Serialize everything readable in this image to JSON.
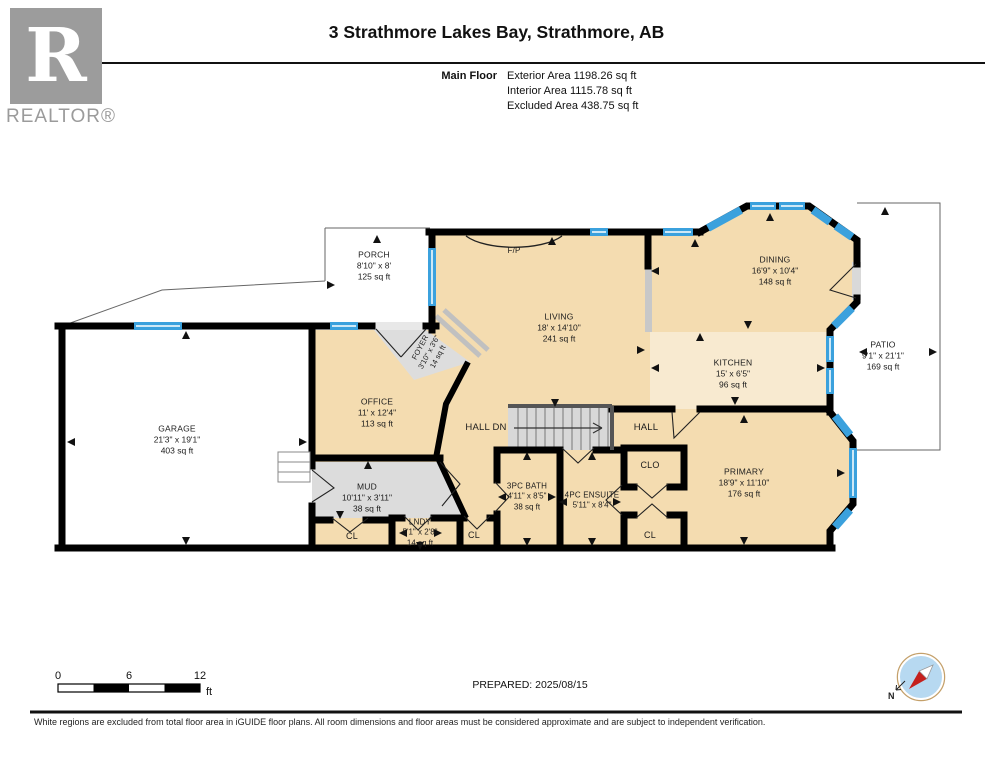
{
  "header": {
    "title": "3 Strathmore Lakes Bay, Strathmore, AB",
    "floor_label": "Main Floor",
    "stats": {
      "exterior": "Exterior Area 1198.26 sq ft",
      "interior": "Interior Area 1115.78 sq ft",
      "excluded": "Excluded Area 438.75 sq ft"
    }
  },
  "logo": {
    "letter": "R",
    "word": "REALTOR®"
  },
  "rooms": {
    "garage": {
      "name": "GARAGE",
      "dims": "21'3\" x 19'1\"",
      "area": "403 sq ft"
    },
    "porch": {
      "name": "PORCH",
      "dims": "8'10\" x 8'",
      "area": "125 sq ft"
    },
    "living": {
      "name": "LIVING",
      "dims": "18' x 14'10\"",
      "area": "241 sq ft"
    },
    "dining": {
      "name": "DINING",
      "dims": "16'9\" x 10'4\"",
      "area": "148 sq ft"
    },
    "patio": {
      "name": "PATIO",
      "dims": "9'1\" x 21'1\"",
      "area": "169 sq ft"
    },
    "kitchen": {
      "name": "KITCHEN",
      "dims": "15' x 6'5\"",
      "area": "96 sq ft"
    },
    "office": {
      "name": "OFFICE",
      "dims": "11' x 12'4\"",
      "area": "113 sq ft"
    },
    "foyer": {
      "name": "FOYER",
      "dims": "3'10\" x 3'6\"",
      "area": "14 sq ft"
    },
    "mud": {
      "name": "MUD",
      "dims": "10'11\" x 3'11\"",
      "area": "38 sq ft"
    },
    "lndy": {
      "name": "LNDY",
      "dims": "5'1\" x 2'8\"",
      "area": "14 sq ft"
    },
    "bath3pc": {
      "name": "3PC BATH",
      "dims": "4'11\" x 8'5\"",
      "area": "38 sq ft"
    },
    "ensuite": {
      "name": "4PC ENSUITE",
      "dims": "5'11\" x 8'4\""
    },
    "primary": {
      "name": "PRIMARY",
      "dims": "18'9\" x 11'10\"",
      "area": "176 sq ft"
    },
    "hall_dn": {
      "name": "HALL DN"
    },
    "hall": {
      "name": "HALL"
    },
    "clo": {
      "name": "CLO"
    },
    "cl_left": {
      "name": "CL"
    },
    "cl_mid": {
      "name": "CL"
    },
    "cl_right": {
      "name": "CL"
    },
    "fireplace": {
      "name": "F/P"
    }
  },
  "scale_bar": {
    "t0": "0",
    "t6": "6",
    "t12": "12",
    "unit": "ft"
  },
  "compass": {
    "north": "N"
  },
  "footer": {
    "prepared": "PREPARED: 2025/08/15",
    "disclaimer": "White regions are excluded from total floor area in iGUIDE floor plans. All room dimensions and floor areas must be considered approximate and are subject to independent verification."
  },
  "colors": {
    "wall": "#000000",
    "room_tan": "#f4dcb0",
    "kitchen_cream": "#f8ead0",
    "utility_gray": "#dcdcdc",
    "window_blue": "#3ba1dd",
    "logo_gray": "#9c9c9c"
  }
}
